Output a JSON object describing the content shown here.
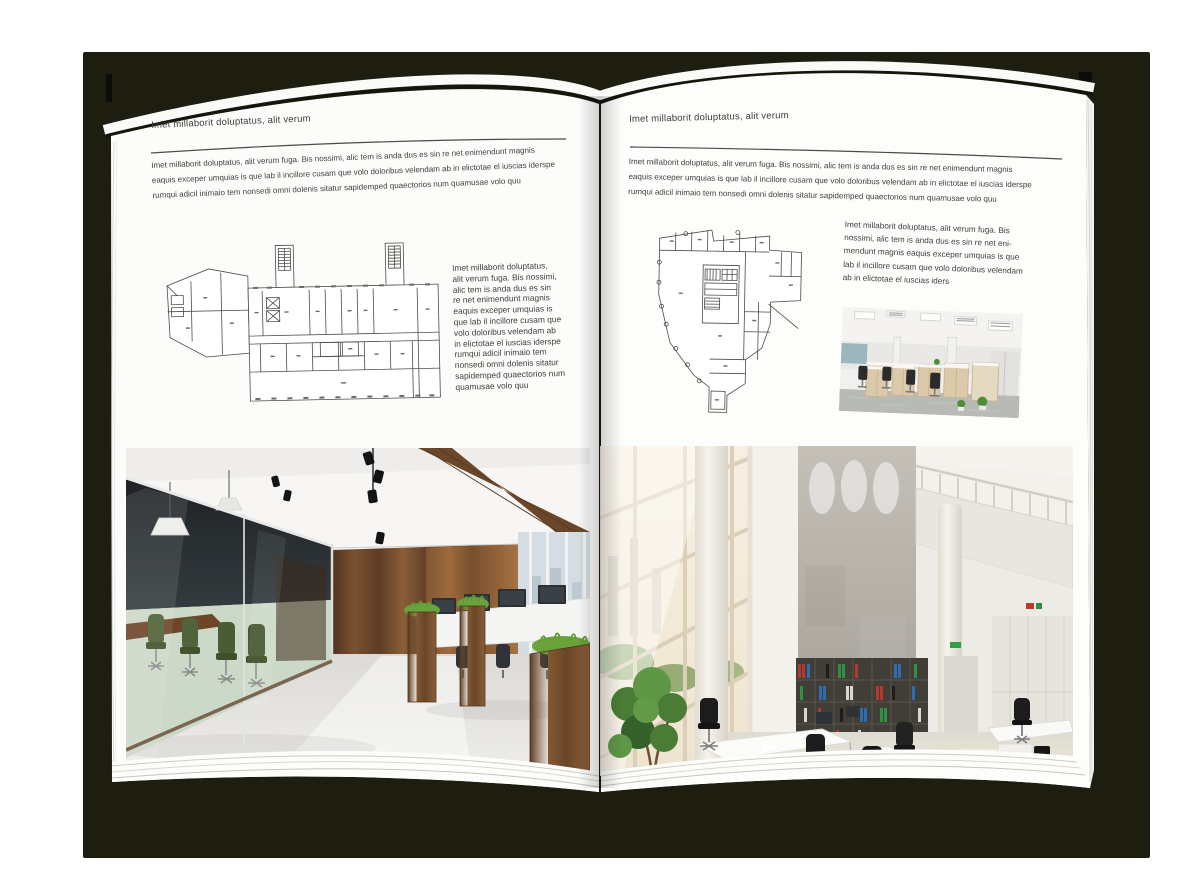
{
  "spread": {
    "left_page": {
      "header": "Imet millaborit doluptatus, alit verum",
      "intro": "Imet millaborit doluptatus, alit verum fuga. Bis nossimi, alic tem is anda dus es sin re net enimendunt magnis\neaquis exceper umquias is que lab il incillore cusam que volo doloribus velendam ab in elictotae el iuscias iderspe\nrumqui adicil inimaio tem nonsedi omni dolenis sitatur sapidemped quaectorios num quamusae volo quu",
      "caption": "Imet millaborit doluptatus,\nalit verum fuga. Bis nossimi,\nalic tem is anda dus es sin\nre net enimendunt magnis\neaquis exceper umquias is\nque lab il incillore cusam que\nvolo doloribus velendam ab\nin elictotae el iuscias iderspe\nrumqui adicil inimaio tem\nnonsedi omni dolenis sitatur\nsapidemped quaectorios num\nquamusae volo quu"
    },
    "right_page": {
      "header": "Imet millaborit doluptatus, alit verum",
      "intro": "Imet millaborit doluptatus, alit verum fuga. Bis nossimi, alic tem is anda dus es sin re net enimendunt magnis\neaquis exceper umquias is que lab il incillore cusam que volo doloribus velendam ab in elictotae el iuscias iderspe\nrumqui adicil inimaio tem nonsedi omni dolenis sitatur sapidemped quaectorios num quamusae volo quu",
      "caption": "Imet millaborit doluptatus, alit verum fuga. Bis\nnossimi, alic tem is anda dus es sin re net eni-\nmendunt magnis eaquis exceper umquias is que\nlab il incillore cusam que volo doloribus velendam\nab in elictotae el iuscias iders"
    },
    "palette": {
      "backdrop": "#1d1e10",
      "page": "#fcfcfb",
      "rule_line": "#4a4a48",
      "plan_line": "#4c4b46",
      "wood": "#6f4a2c",
      "meeting_chair_green": "#4d5f33",
      "binder_red": "#b43a30",
      "binder_blue": "#2e6cb2",
      "binder_green": "#2f9144"
    }
  }
}
